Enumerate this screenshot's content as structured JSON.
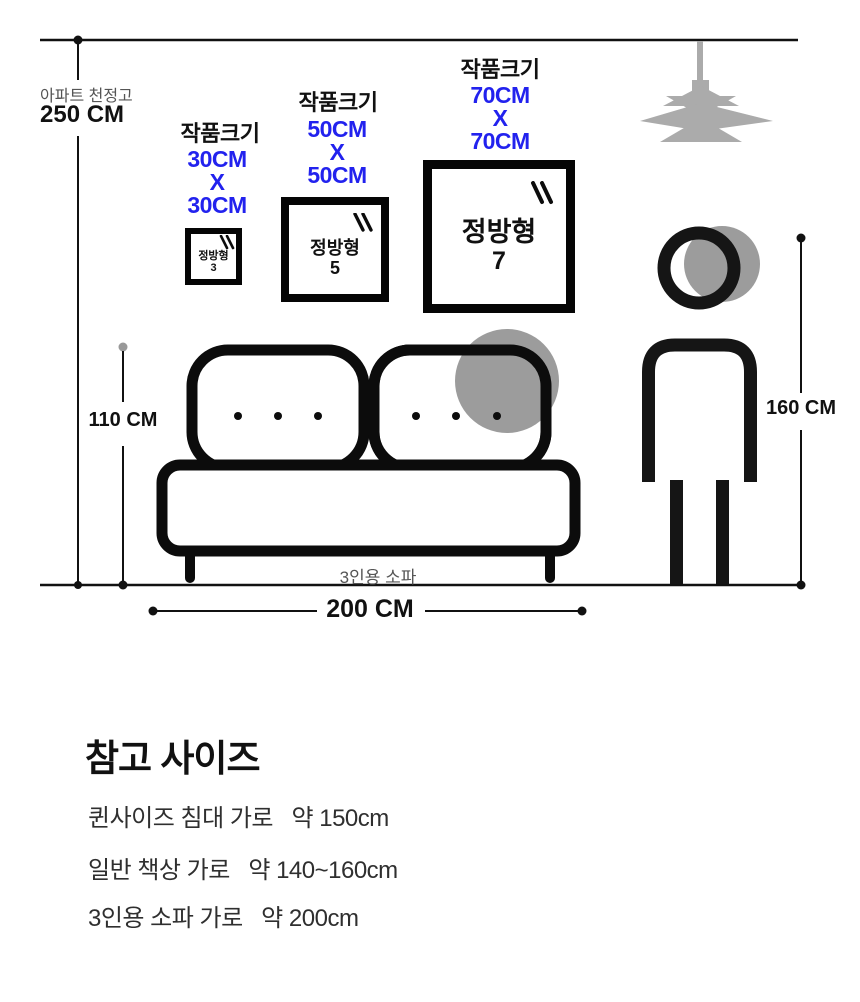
{
  "scene": {
    "ceiling": {
      "label": "아파트 천정고",
      "value": "250 CM"
    },
    "artworks": [
      {
        "caption": "작품크기",
        "w": "30CM",
        "x": "X",
        "h": "30CM",
        "frame_name": "정방형",
        "frame_no": "3"
      },
      {
        "caption": "작품크기",
        "w": "50CM",
        "x": "X",
        "h": "50CM",
        "frame_name": "정방형",
        "frame_no": "5"
      },
      {
        "caption": "작품크기",
        "w": "70CM",
        "x": "X",
        "h": "70CM",
        "frame_name": "정방형",
        "frame_no": "7"
      }
    ],
    "sofa": {
      "label": "3인용 소파",
      "height": "110 CM",
      "width": "200 CM"
    },
    "person": {
      "height": "160 CM"
    }
  },
  "reference": {
    "title": "참고 사이즈",
    "items": [
      "퀸사이즈 침대 가로   약 150cm",
      "일반 책상 가로   약 140~160cm",
      "3인용 소파 가로   약 200cm"
    ]
  },
  "colors": {
    "accent_blue": "#2222ee",
    "figure_gray": "#9c9c9c",
    "lamp_gray": "#ababab",
    "ink": "#111111"
  }
}
